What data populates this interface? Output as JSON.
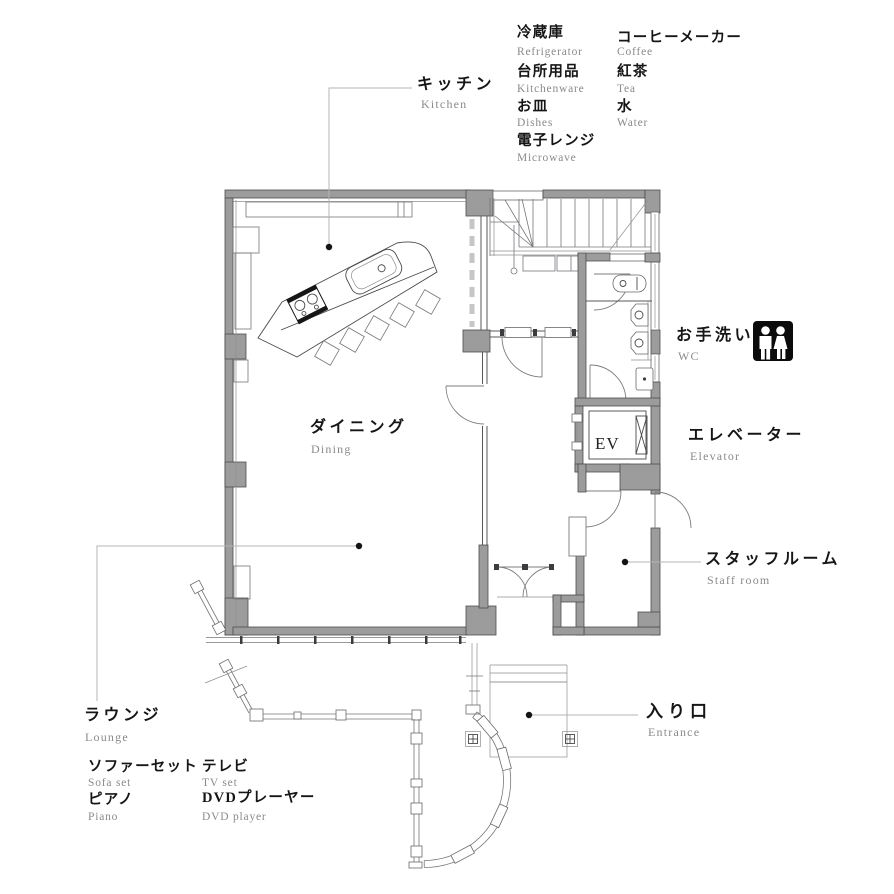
{
  "palette": {
    "wall_gray": "#9c9c9c",
    "wall_edge": "#4d4d4d",
    "line_dark": "#58585a",
    "line_light": "#b4b4b4",
    "text_main": "#161616",
    "text_sub": "#8a8a8a",
    "icon_bg": "#0b0b0b"
  },
  "legend_kitchen": {
    "col1": [
      {
        "jp": "冷蔵庫",
        "en": "Refrigerator"
      },
      {
        "jp": "台所用品",
        "en": "Kitchenware"
      },
      {
        "jp": "お皿",
        "en": "Dishes"
      },
      {
        "jp": "電子レンジ",
        "en": "Microwave"
      }
    ],
    "col2": [
      {
        "jp": "コーヒーメーカー",
        "en": "Coffee"
      },
      {
        "jp": "紅茶",
        "en": "Tea"
      },
      {
        "jp": "水",
        "en": "Water"
      }
    ]
  },
  "rooms": {
    "kitchen": {
      "jp": "キッチン",
      "en": "Kitchen"
    },
    "dining": {
      "jp": "ダイニング",
      "en": "Dining"
    },
    "wc": {
      "jp": "お手洗い",
      "en": "WC"
    },
    "elevator": {
      "jp": "エレベーター",
      "en": "Elevator"
    },
    "staff_room": {
      "jp": "スタッフルーム",
      "en": "Staff room"
    },
    "entrance": {
      "jp": "入り口",
      "en": "Entrance"
    },
    "lounge": {
      "jp": "ラウンジ",
      "en": "Lounge"
    }
  },
  "legend_lounge": {
    "col1": [
      {
        "jp": "ソファーセット",
        "en": "Sofa set"
      },
      {
        "jp": "ピアノ",
        "en": "Piano"
      }
    ],
    "col2": [
      {
        "jp": "テレビ",
        "en": "TV set"
      },
      {
        "jp": "DVDプレーヤー",
        "en": "DVD player"
      }
    ]
  },
  "plan": {
    "elevator_car_label": "EV"
  },
  "icons": {
    "wc_icon": "restroom-male-female"
  }
}
